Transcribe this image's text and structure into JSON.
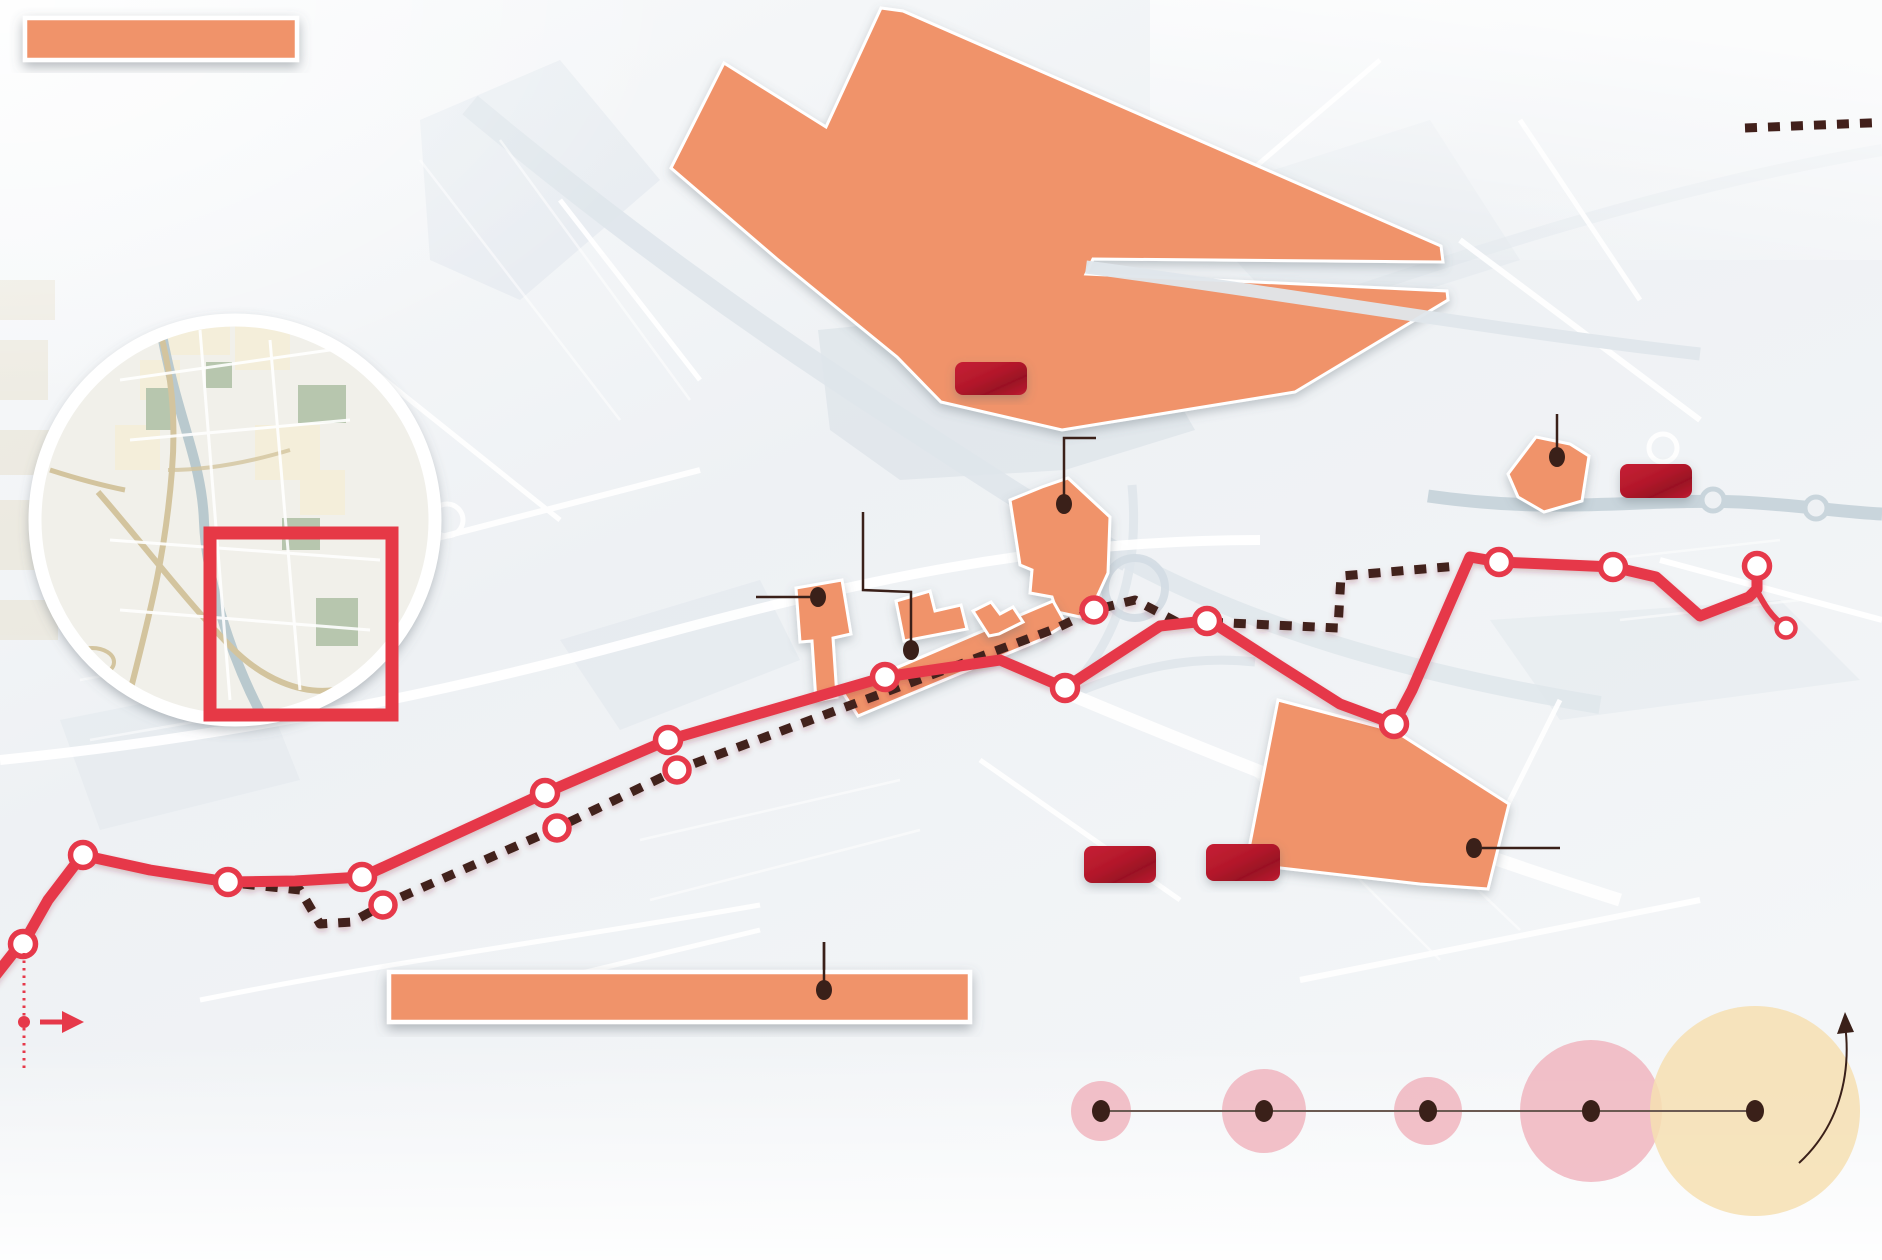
{
  "title": "transit-route-infographic-map",
  "colors": {
    "zone_orange": "#f0936a",
    "route_red": "#e6394a",
    "alt_dark": "#42201b",
    "leader_dark": "#3a2019",
    "badge_red": "#c41f33",
    "badge_red_dark": "#9a1124",
    "square_red": "#e63946",
    "bubble_pink": "#efb0ba",
    "bubble_yellow": "#f6dfb2",
    "axis_gray": "#6b5a52",
    "patch_gray": "#dee5ea",
    "band_gray": "#dfe6eb",
    "river_gray": "#c9d5dc",
    "tan_road": "#d3c49e"
  },
  "legend": {
    "zone_swatch": {
      "x": 25,
      "y": 18,
      "w": 272,
      "h": 42
    },
    "dashed_sample_path": "M 1745,128 L 1892,122"
  },
  "inset": {
    "cx": 235,
    "cy": 520,
    "r": 200,
    "red_square": {
      "x": 210,
      "y": 533,
      "w": 182,
      "h": 182,
      "stroke_w": 13
    }
  },
  "slit_band_path": "M 1086,267 C 1300,296 1500,331 1700,354",
  "zones": [
    {
      "name": "zone-district-north",
      "path": "M 671,168 L 724,63 L 826,127 L 881,8 L 903,11 L 1441,246 L 1443,262 L 1093,259 L 1086,274 L 1447,291 L 1448,300 L 1295,392 L 1062,430 L 941,402 L 897,357 L 777,259 Z"
    },
    {
      "name": "zone-district-mid",
      "path": "M 1068,478 L 1110,517 L 1108,573 L 1097,597 L 1080,617 L 1057,612 L 1052,597 L 1030,593 L 1032,570 L 1020,565 L 1010,500 L 1042,487 Z"
    },
    {
      "name": "zone-strip",
      "path": "M 842,691 L 1053,601 L 1066,624 L 1040,640 L 858,716 Z"
    },
    {
      "name": "zone-building-west",
      "path": "M 796,588 L 842,580 L 851,634 L 833,638 L 837,697 L 816,701 L 812,641 L 800,642 Z"
    },
    {
      "name": "zone-building-a",
      "path": "M 896,601 L 930,591 L 935,611 L 961,605 L 967,629 L 904,641 Z"
    },
    {
      "name": "zone-building-b",
      "path": "M 973,611 L 991,602 L 1000,614 L 1013,607 L 1023,622 L 999,634 L 989,636 Z"
    },
    {
      "name": "zone-district-southeast",
      "path": "M 1278,700 L 1395,731 L 1509,804 L 1488,889 L 1420,884 L 1246,864 Z"
    },
    {
      "name": "zone-wedge-east",
      "path": "M 1508,474 L 1536,437 L 1570,444 L 1589,456 L 1582,501 L 1544,512 L 1518,497 Z"
    }
  ],
  "bottom_bar": {
    "x": 389,
    "y": 972,
    "w": 581,
    "h": 50
  },
  "routes": {
    "tram": {
      "width": 11,
      "path": "M -8,980 L 14,952 L 23,944 L 48,900 L 80,858 L 86,856 L 150,870 L 228,882 L 295,881 L 362,877 L 545,793 L 668,740 L 885,677 L 1000,660 L 1065,688 L 1160,626 L 1205,621 L 1215,624 L 1280,666 L 1340,704 L 1394,724 L 1412,690 L 1470,557 L 1499,562 L 1613,567 L 1656,577 L 1700,616 L 1749,597 L 1757,589 L 1757,566"
    },
    "tail": {
      "width": 6,
      "path": "M 1757,591 C 1765,606 1770,615 1786,628"
    },
    "alt": {
      "width": 9,
      "dash": "12 11",
      "path": "M 243,884 L 300,890 L 320,924 L 352,922 L 383,905 L 557,828 L 677,770 L 1057,628 L 1094,610 L 1135,600 L 1177,622 L 1207,622 L 1338,628 L 1341,576 L 1458,566"
    }
  },
  "stops": {
    "main": [
      [
        23,
        944
      ],
      [
        83,
        855
      ],
      [
        228,
        882
      ],
      [
        362,
        877
      ],
      [
        545,
        793
      ],
      [
        668,
        740
      ],
      [
        885,
        677
      ],
      [
        1065,
        688
      ],
      [
        1207,
        621
      ],
      [
        1394,
        724
      ],
      [
        1499,
        562
      ],
      [
        1613,
        567
      ],
      [
        1757,
        566
      ]
    ],
    "alt": [
      [
        383,
        905
      ],
      [
        557,
        828
      ],
      [
        677,
        770
      ],
      [
        1094,
        610
      ]
    ],
    "terminal": [
      1786,
      628
    ]
  },
  "badges": [
    {
      "name": "badge-1",
      "x": 955,
      "y": 362,
      "w": 72,
      "h": 33
    },
    {
      "name": "badge-2",
      "x": 1620,
      "y": 464,
      "w": 72,
      "h": 34
    },
    {
      "name": "badge-3",
      "x": 1084,
      "y": 846,
      "w": 72,
      "h": 37
    },
    {
      "name": "badge-4",
      "x": 1206,
      "y": 844,
      "w": 74,
      "h": 37
    }
  ],
  "callouts": [
    {
      "name": "callout-building-west",
      "path": "M 756,597 L 810,597",
      "dot": [
        818,
        597
      ]
    },
    {
      "name": "callout-strip",
      "path": "M 863,512 L 863,590 L 911,592 L 911,644",
      "dot": [
        911,
        650
      ]
    },
    {
      "name": "callout-district-mid",
      "path": "M 1096,438 L 1064,438 L 1064,498",
      "dot": [
        1064,
        504
      ]
    },
    {
      "name": "callout-wedge",
      "path": "M 1557,414 L 1557,451",
      "dot": [
        1557,
        457
      ]
    },
    {
      "name": "callout-southeast",
      "path": "M 1560,848 L 1482,848",
      "dot": [
        1474,
        848
      ]
    },
    {
      "name": "callout-bottom-bar",
      "path": "M 824,942 L 824,984",
      "dot": [
        824,
        990
      ]
    }
  ],
  "west_marker": {
    "dotted_path": "M 24,953 L 24,1070",
    "dot": [
      24,
      1022
    ],
    "arrow_path": "M 40,1022 L 64,1022",
    "arrow_head": "M 62,1011 L 84,1022 L 62,1033 Z"
  },
  "bubble_scale": {
    "cy": 1111,
    "axis": {
      "x1": 1101,
      "x2": 1755
    },
    "bubbles": [
      {
        "cx": 1101,
        "r": 30,
        "kind": "pink"
      },
      {
        "cx": 1264,
        "r": 42,
        "kind": "pink"
      },
      {
        "cx": 1428,
        "r": 34,
        "kind": "pink"
      },
      {
        "cx": 1591,
        "r": 71,
        "kind": "pink"
      },
      {
        "cx": 1755,
        "r": 105,
        "kind": "yellow"
      }
    ],
    "dots": [
      1101,
      1264,
      1428,
      1591,
      1755
    ],
    "arrow_path": "M 1799,1163 C 1837,1128 1852,1078 1845,1024",
    "arrow_head": "M 1837,1034 L 1845,1012 L 1854,1032 Z"
  }
}
